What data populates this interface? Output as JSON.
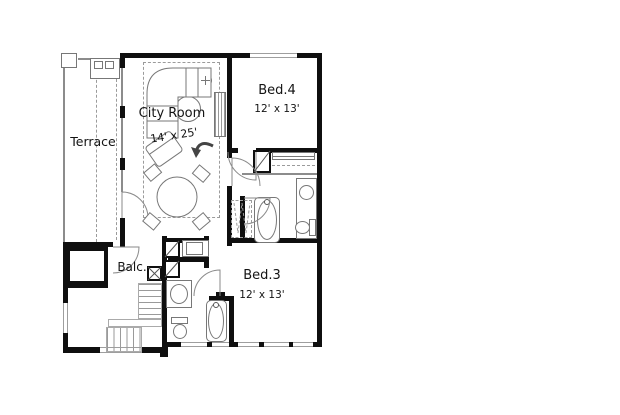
{
  "plan": {
    "rooms": {
      "terrace": {
        "label": "Terrace"
      },
      "city_room": {
        "label": "City Room",
        "dims": "14' x 25'"
      },
      "bed4": {
        "label": "Bed.4",
        "dims": "12' x 13'"
      },
      "bed3": {
        "label": "Bed.3",
        "dims": "12' x 13'"
      },
      "balcony": {
        "label": "Balc."
      }
    },
    "colors": {
      "wall": "#0f0f0f",
      "thin_line": "#8c8c8c",
      "dashed_line": "#9b9b9b",
      "fixture_line": "#777777",
      "window_line": "#9e9e9e",
      "text": "#141414",
      "background": "#ffffff"
    },
    "symbols": [
      "door-swing",
      "window",
      "bathtub",
      "toilet",
      "sink",
      "vanity-counter",
      "stairs",
      "elevator-shaft",
      "sofa",
      "armchair",
      "round-chair",
      "dining-table",
      "dining-chair",
      "ceiling-speaker",
      "media-console",
      "wardrobe",
      "closet",
      "washer",
      "grill-counter",
      "north-arrow"
    ]
  }
}
